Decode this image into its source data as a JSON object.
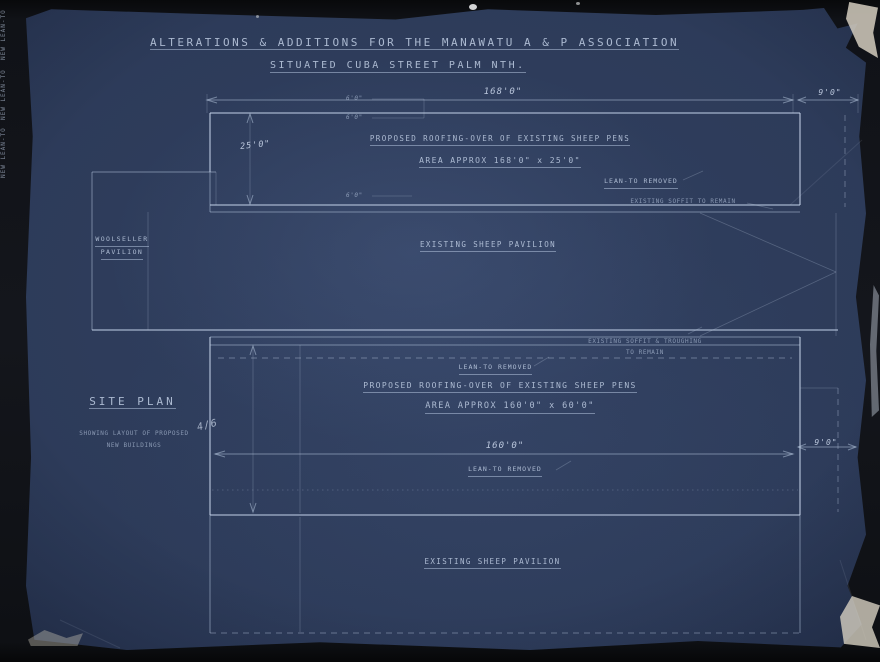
{
  "title": {
    "line1": "ALTERATIONS & ADDITIONS FOR THE MANAWATU A & P ASSOCIATION",
    "line2": "SITUATED CUBA STREET PALM NTH."
  },
  "upper_plan": {
    "heading": "PROPOSED ROOFING-OVER OF EXISTING SHEEP PENS",
    "area_note": "AREA APPROX 168'0\" x 25'0\"",
    "width_dim": "168'0\"",
    "right_dim": "9'0\"",
    "height_dim": "25'0\"",
    "bay_dim": "6'0\"",
    "lean_to_note": "LEAN-TO REMOVED",
    "soffit_note": "EXISTING SOFFIT TO REMAIN",
    "new_lean_to_label": "NEW LEAN-TO"
  },
  "pavilion": {
    "label": "EXISTING SHEEP PAVILION",
    "wing_label_line1": "WOOLSELLER",
    "wing_label_line2": "PAVILION",
    "soffit_note_line1": "EXISTING SOFFIT & TROUGHING",
    "soffit_note_line2": "TO REMAIN"
  },
  "lower_plan": {
    "lean_to_note_top": "LEAN-TO REMOVED",
    "heading": "PROPOSED ROOFING-OVER OF EXISTING SHEEP PENS",
    "area_note": "AREA APPROX 160'0\" x 60'0\"",
    "width_dim": "160'0\"",
    "lean_to_note_bottom": "LEAN-TO REMOVED",
    "right_dim": "9'0\"",
    "new_lean_to_label": "NEW LEAN-TO"
  },
  "site_plan": {
    "title": "SITE PLAN",
    "subtitle_line1": "SHOWING LAYOUT OF PROPOSED",
    "subtitle_line2": "NEW BUILDINGS",
    "annotation": "4/6"
  },
  "bottom_plan": {
    "label": "EXISTING SHEEP PAVILION"
  },
  "colors": {
    "paper": "#2c3a58",
    "linework": "#b9c9e0",
    "ink": "#cdd9ee",
    "backdrop": "#0d0e11"
  }
}
